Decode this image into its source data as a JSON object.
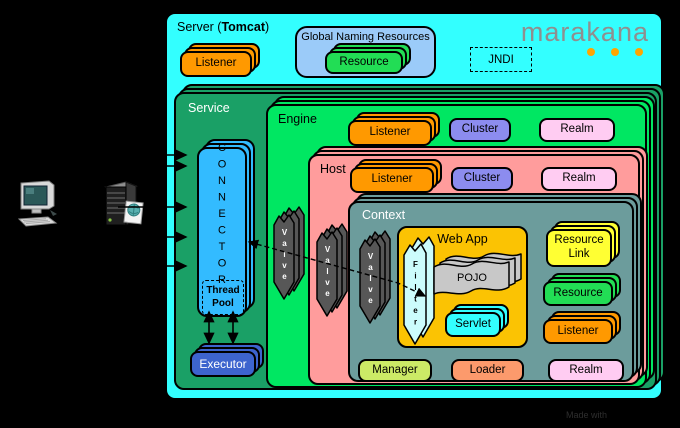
{
  "page": {
    "made_with": "Made with"
  },
  "brand": {
    "logo_text": "marakana",
    "dot_color": "#FFA500"
  },
  "icons": {
    "client": "desktop-computer",
    "web_server": "server-tower"
  },
  "server": {
    "title_prefix": "Server (",
    "title_bold": "Tomcat",
    "title_suffix": ")",
    "listener": "Listener",
    "global_naming_resources": {
      "title": "Global Naming Resources",
      "resource": "Resource"
    },
    "jndi": "JNDI"
  },
  "service": {
    "title": "Service",
    "connector": {
      "vertical_label": "CONNECTOR",
      "thread_pool": "Thread Pool"
    },
    "executor": "Executor"
  },
  "engine": {
    "title": "Engine",
    "listener": "Listener",
    "cluster": "Cluster",
    "realm": "Realm",
    "valve": "Valve"
  },
  "host": {
    "title": "Host",
    "listener": "Listener",
    "cluster": "Cluster",
    "realm": "Realm",
    "valve": "Valve"
  },
  "context": {
    "title": "Context",
    "valve": "Valve",
    "web_app": {
      "title": "Web App",
      "filter": "Filter",
      "pojo": "POJO",
      "servlet": "Servlet"
    },
    "resource_link": "Resource Link",
    "resource": "Resource",
    "listener": "Listener",
    "manager": "Manager",
    "loader": "Loader",
    "realm": "Realm"
  },
  "colors": {
    "server_bg": "#33FFFF",
    "service_bg": "#1AA066",
    "engine_bg": "#00E762",
    "host_bg": "#FF9C9C",
    "context_bg": "#6C9C9C",
    "web_app_bg": "#FBC303",
    "connector_bg": "#33BBFF",
    "executor_bg": "#3D64CE",
    "listener_bg": "#FF9900",
    "cluster_bg": "#8C8CEF",
    "realm_bg": "#FFCCF2",
    "resource_bg": "#22DD55",
    "resource_link_bg": "#FFFF33",
    "servlet_bg": "#33FFFF",
    "manager_bg": "#CCEA66",
    "loader_bg": "#FC9A6C",
    "gnr_bg": "#9BCBF9",
    "valve_bg": "#575757",
    "filter_bg": "#CCFCFC",
    "pojo_bg": "#C8C8C8"
  }
}
